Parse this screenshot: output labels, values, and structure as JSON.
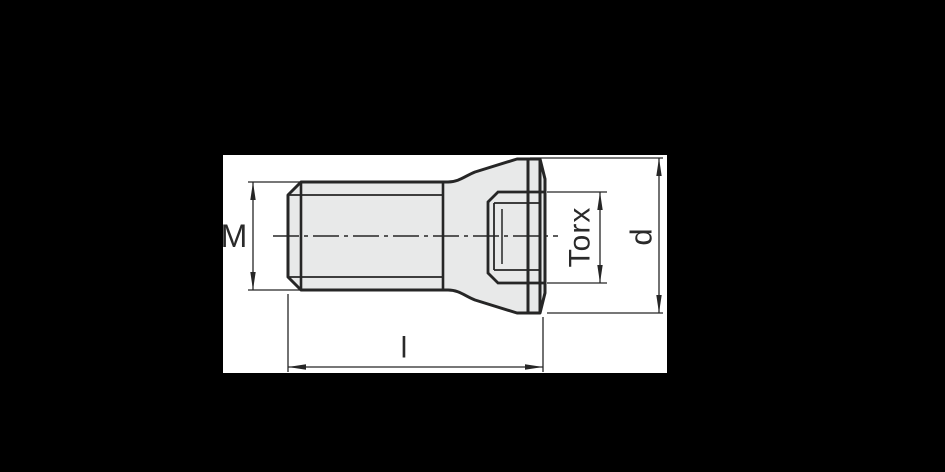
{
  "drawing": {
    "labels": {
      "thread_size": "M",
      "drive": "Torx",
      "head_diameter": "d",
      "length": "l"
    },
    "colors": {
      "canvas": "#000000",
      "paper": "#ffffff",
      "part_fill": "#e8e9e9",
      "line": "#262626",
      "text": "#2a2a2a"
    }
  }
}
